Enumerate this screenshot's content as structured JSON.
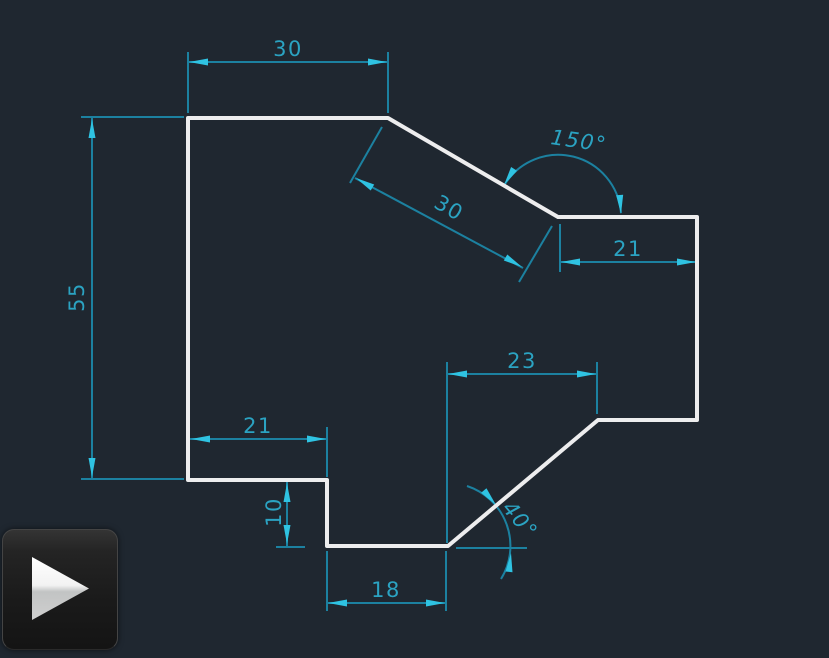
{
  "canvas": {
    "background_color": "#1f2730",
    "outline_color": "#ededee",
    "dim_line_color": "#1c81a0",
    "dim_arrow_color": "#2fc3e2",
    "dim_text_color": "#2ba3c2"
  },
  "dimensions": {
    "top_width": {
      "label": "30"
    },
    "left_height": {
      "label": "55"
    },
    "diagonal_edge": {
      "label": "30"
    },
    "angle_top": {
      "label": "150°"
    },
    "right_width": {
      "label": "21"
    },
    "mid_width": {
      "label": "23"
    },
    "step_width": {
      "label": "21"
    },
    "step_height": {
      "label": "10"
    },
    "bottom_width": {
      "label": "18"
    },
    "angle_bottom": {
      "label": "40°"
    }
  },
  "overlay": {
    "play_icon": "play-icon"
  }
}
